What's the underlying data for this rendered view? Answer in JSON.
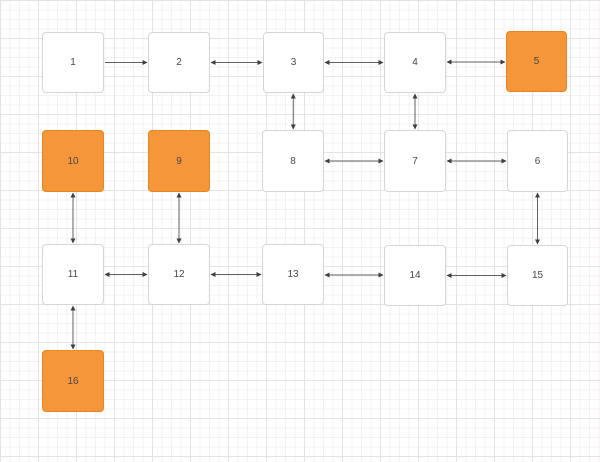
{
  "canvas": {
    "background": "#ffffff",
    "grid": {
      "minor_px": 9.5,
      "major_px": 38,
      "minor_color": "#f4f1f2",
      "major_color": "#e6e2e3"
    }
  },
  "colors": {
    "node_fill": "#ffffff",
    "node_border": "#d5d5d5",
    "highlight_fill": "#f5963a",
    "highlight_border": "#e5861f",
    "label_text": "#474747",
    "edge_line": "#616161",
    "arrowhead": "#3f3f3f"
  },
  "nodes": [
    {
      "id": "1",
      "label": "1",
      "x": 42,
      "y": 32,
      "w": 62,
      "h": 61,
      "highlight": false
    },
    {
      "id": "2",
      "label": "2",
      "x": 148,
      "y": 32,
      "w": 62,
      "h": 61,
      "highlight": false
    },
    {
      "id": "3",
      "label": "3",
      "x": 263,
      "y": 32,
      "w": 61,
      "h": 61,
      "highlight": false
    },
    {
      "id": "4",
      "label": "4",
      "x": 384,
      "y": 32,
      "w": 62,
      "h": 61,
      "highlight": false
    },
    {
      "id": "5",
      "label": "5",
      "x": 506,
      "y": 31,
      "w": 61,
      "h": 61,
      "highlight": true
    },
    {
      "id": "10",
      "label": "10",
      "x": 42,
      "y": 130,
      "w": 62,
      "h": 62,
      "highlight": true
    },
    {
      "id": "9",
      "label": "9",
      "x": 148,
      "y": 130,
      "w": 62,
      "h": 62,
      "highlight": true
    },
    {
      "id": "8",
      "label": "8",
      "x": 262,
      "y": 130,
      "w": 62,
      "h": 62,
      "highlight": false
    },
    {
      "id": "7",
      "label": "7",
      "x": 384,
      "y": 130,
      "w": 62,
      "h": 62,
      "highlight": false
    },
    {
      "id": "6",
      "label": "6",
      "x": 507,
      "y": 130,
      "w": 61,
      "h": 62,
      "highlight": false
    },
    {
      "id": "11",
      "label": "11",
      "x": 42,
      "y": 244,
      "w": 62,
      "h": 61,
      "highlight": false
    },
    {
      "id": "12",
      "label": "12",
      "x": 148,
      "y": 244,
      "w": 62,
      "h": 61,
      "highlight": false
    },
    {
      "id": "13",
      "label": "13",
      "x": 262,
      "y": 244,
      "w": 62,
      "h": 61,
      "highlight": false
    },
    {
      "id": "14",
      "label": "14",
      "x": 384,
      "y": 245,
      "w": 62,
      "h": 61,
      "highlight": false
    },
    {
      "id": "15",
      "label": "15",
      "x": 507,
      "y": 245,
      "w": 61,
      "h": 61,
      "highlight": false
    },
    {
      "id": "16",
      "label": "16",
      "x": 42,
      "y": 350,
      "w": 62,
      "h": 62,
      "highlight": true
    }
  ],
  "edges": [
    {
      "from": "1",
      "to": "2",
      "arrows": "forward"
    },
    {
      "from": "2",
      "to": "3",
      "arrows": "both"
    },
    {
      "from": "3",
      "to": "4",
      "arrows": "both"
    },
    {
      "from": "4",
      "to": "5",
      "arrows": "both"
    },
    {
      "from": "3",
      "to": "8",
      "arrows": "both"
    },
    {
      "from": "4",
      "to": "7",
      "arrows": "both"
    },
    {
      "from": "8",
      "to": "7",
      "arrows": "both"
    },
    {
      "from": "7",
      "to": "6",
      "arrows": "both"
    },
    {
      "from": "10",
      "to": "11",
      "arrows": "both"
    },
    {
      "from": "9",
      "to": "12",
      "arrows": "both"
    },
    {
      "from": "6",
      "to": "15",
      "arrows": "both"
    },
    {
      "from": "11",
      "to": "12",
      "arrows": "both"
    },
    {
      "from": "12",
      "to": "13",
      "arrows": "both"
    },
    {
      "from": "13",
      "to": "14",
      "arrows": "both"
    },
    {
      "from": "14",
      "to": "15",
      "arrows": "both"
    },
    {
      "from": "11",
      "to": "16",
      "arrows": "both"
    }
  ]
}
